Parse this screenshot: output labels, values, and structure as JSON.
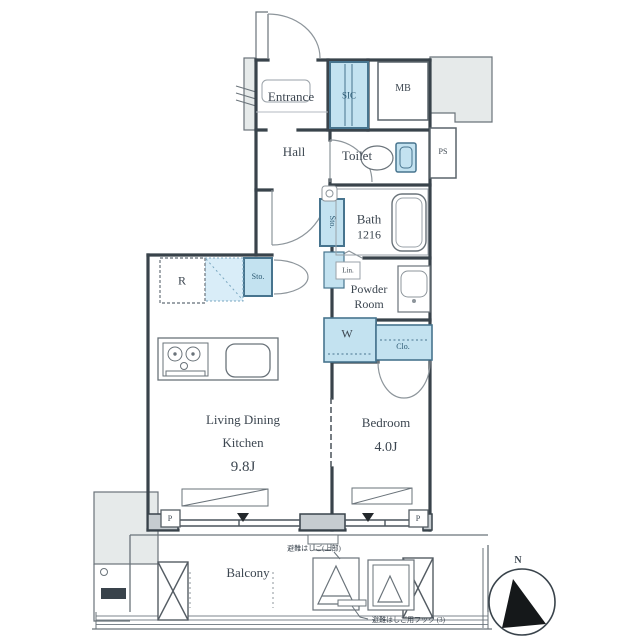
{
  "colors": {
    "wall": "#39434b",
    "thin": "#6a737a",
    "gray_fill": "#e6eaea",
    "blue_fill": "#c3e2f0",
    "blue_light": "#d9edf8",
    "text": "#3c4650"
  },
  "rooms": {
    "entrance": {
      "label": "Entrance"
    },
    "sic": {
      "label": "SIC"
    },
    "mb": {
      "label": "MB"
    },
    "hall": {
      "label": "Hall"
    },
    "toilet": {
      "label": "Toilet"
    },
    "ps": {
      "label": "PS"
    },
    "bath": {
      "label": "Bath",
      "size": "1216"
    },
    "storage_hall": {
      "label": "Sto."
    },
    "linen": {
      "label": "Lin."
    },
    "powder_room": {
      "line1": "Powder",
      "line2": "Room"
    },
    "washer": {
      "label": "W"
    },
    "closet": {
      "label": "Clo."
    },
    "refrigerator": {
      "label": "R"
    },
    "storage_kitchen": {
      "label": "Sto."
    },
    "ldk": {
      "line1": "Living Dining",
      "line2": "Kitchen",
      "size": "9.8J"
    },
    "bedroom": {
      "label": "Bedroom",
      "size": "4.0J"
    },
    "balcony": {
      "label": "Balcony"
    }
  },
  "markers": {
    "pillar_left": "P",
    "pillar_right": "P",
    "compass_north": "N",
    "hatch_note": "避難はしご(上部)",
    "footnote": "避難はしご用フック (3)"
  }
}
